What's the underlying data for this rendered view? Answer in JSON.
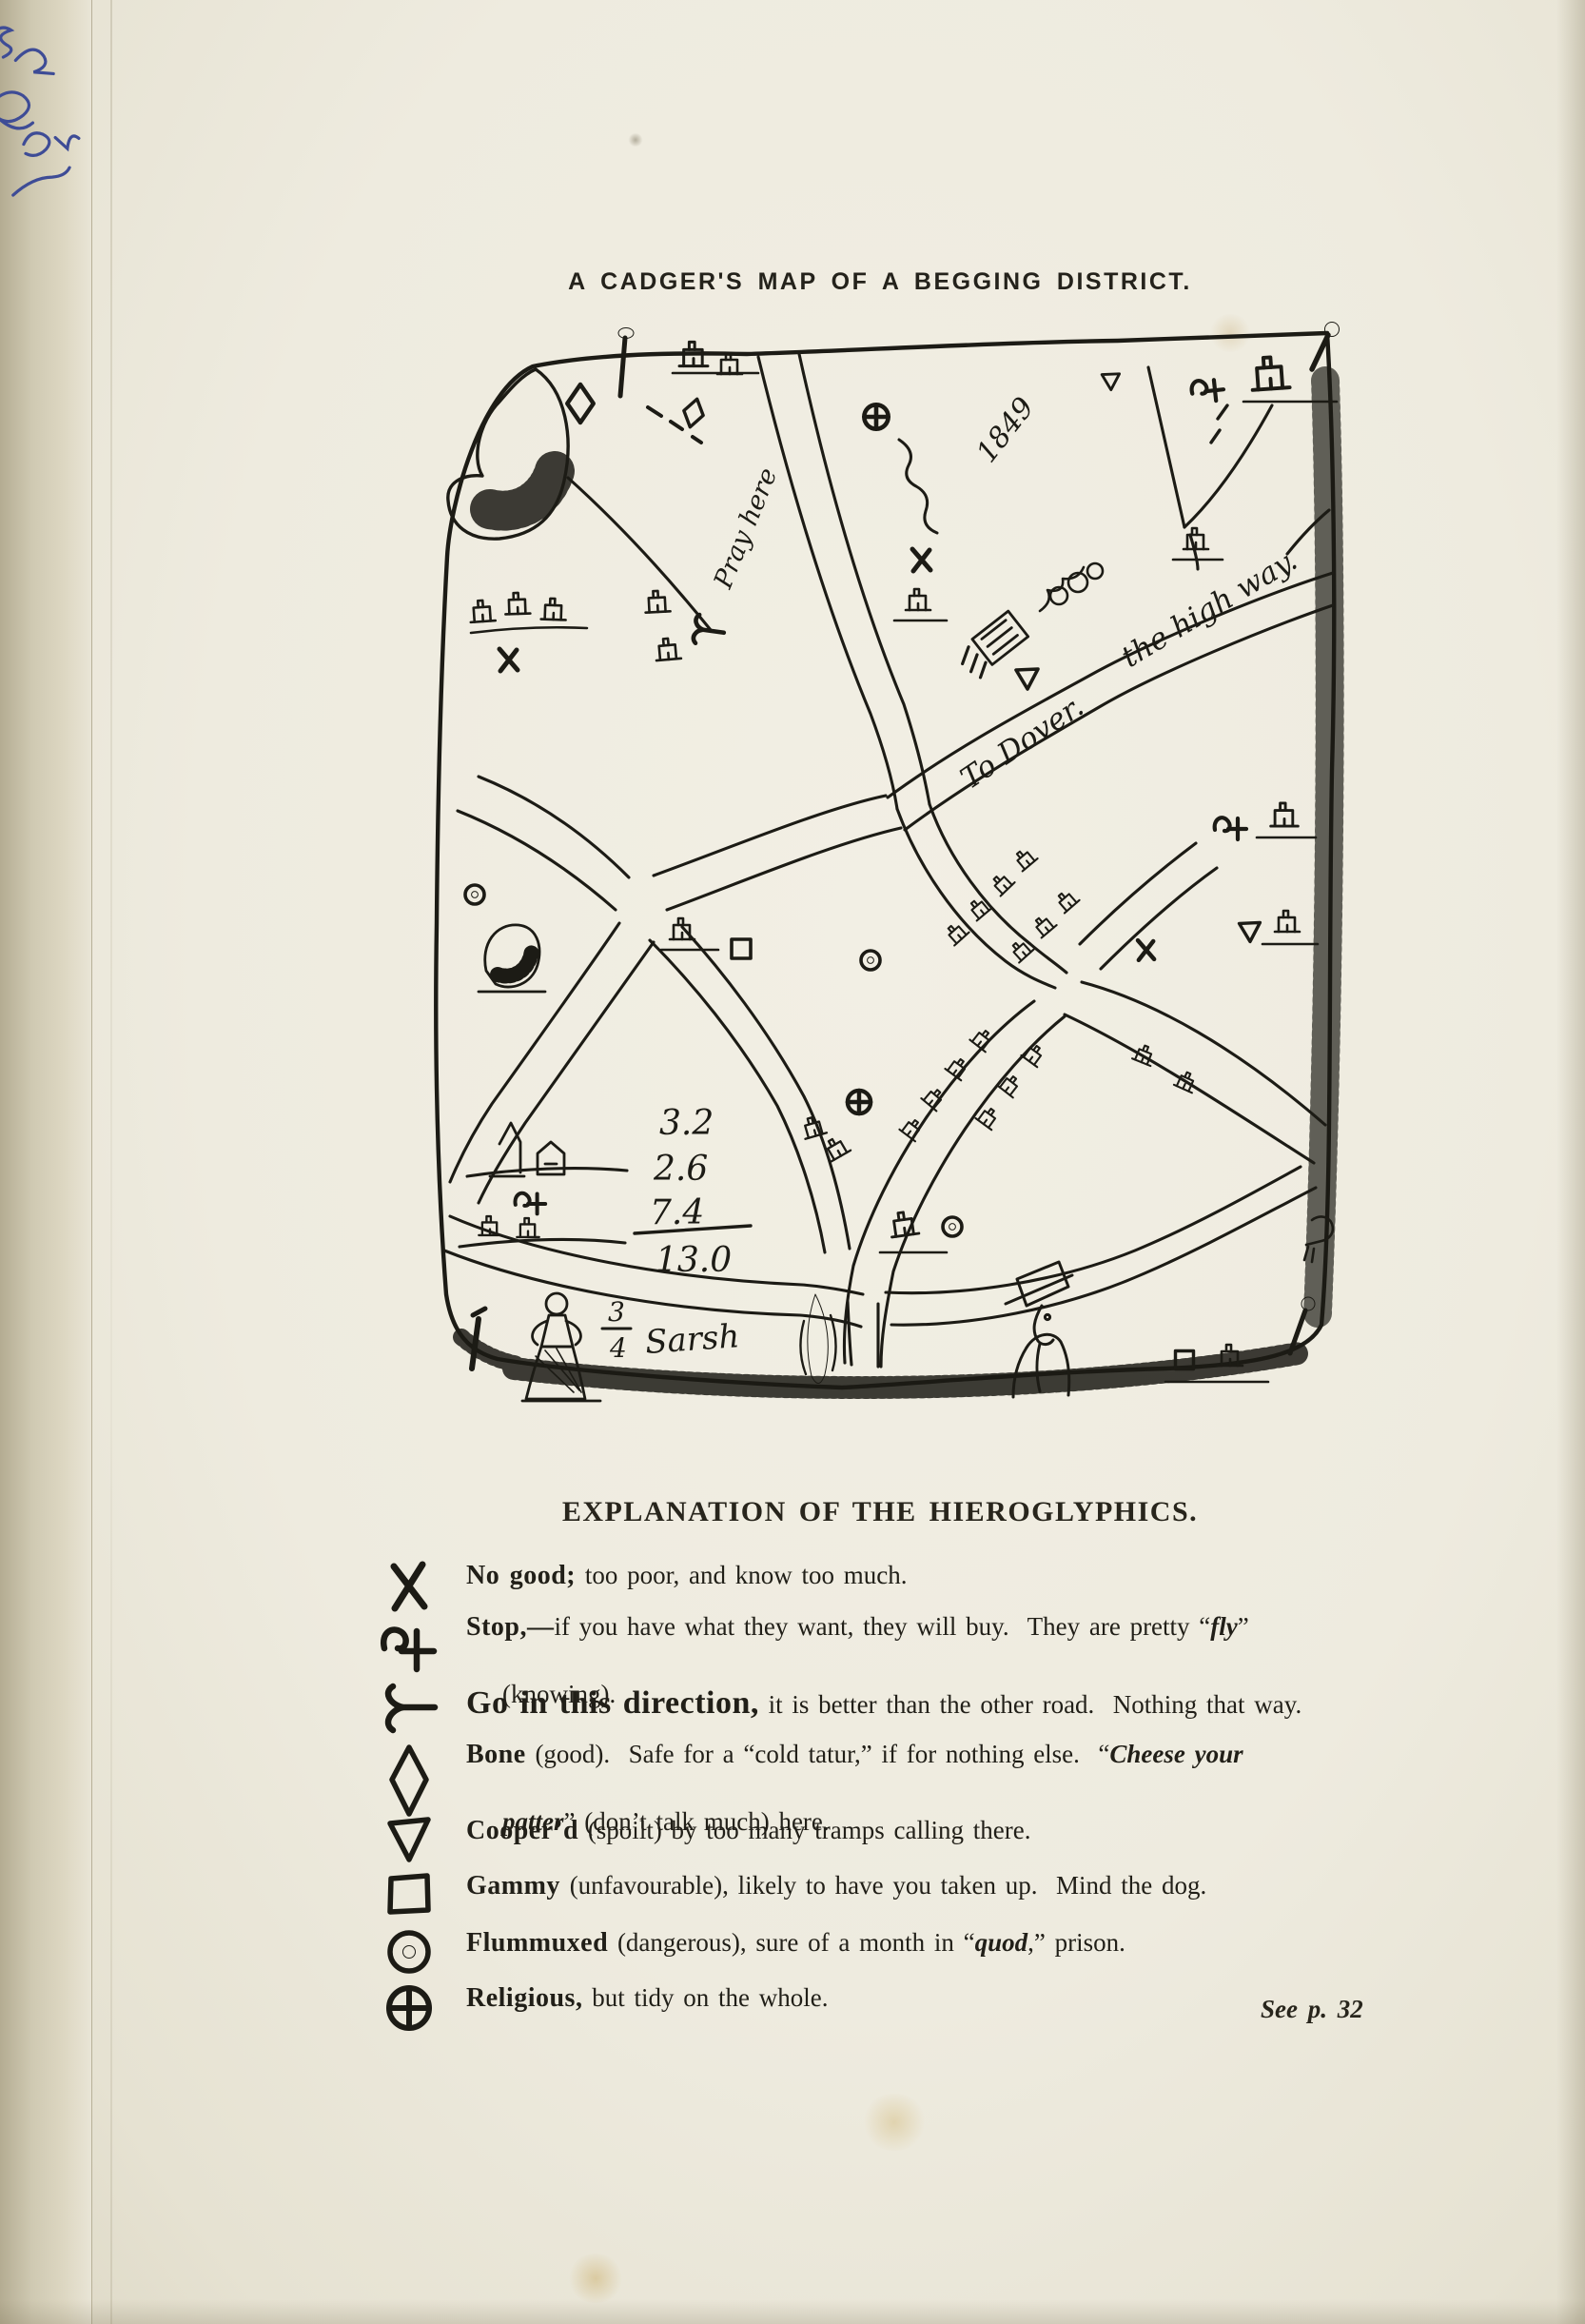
{
  "page": {
    "title": "A CADGER'S MAP OF A BEGGING DISTRICT.",
    "heading": "EXPLANATION OF THE HIEROGLYPHICS.",
    "see_note": "See p. 32",
    "marginalia": "(illegible blue-ink handwriting)"
  },
  "map": {
    "year": "1849",
    "pray_here": "Pray here",
    "to_dover": "To Dover.",
    "high_way": "the high way.",
    "sum_lines": [
      "3.2",
      "2.6",
      "7.4",
      "13.0"
    ],
    "fraction_top": "3",
    "fraction_bottom": "4",
    "sarsh": "Sarsh"
  },
  "legend": {
    "items": [
      {
        "symbol": "x-mark",
        "term": "No good;",
        "rest": " too poor, and know too much."
      },
      {
        "symbol": "stop-squiggle-cross",
        "term": "Stop,—",
        "rest": "if you have what they want, they will buy.  They are pretty “",
        "italic": "fly",
        "rest2": "”",
        "line2": "(knowing)."
      },
      {
        "symbol": "fork-direction",
        "term": "Go in this direction,",
        "rest": " it is better than the other road.  Nothing that way."
      },
      {
        "symbol": "diamond",
        "term": "Bone",
        "rest": " (good).  Safe for a “cold tatur,” if for nothing else.  “",
        "italic": "Cheese your",
        "line2_italic": "patter",
        "line2_rest": "” (don’t talk much) here."
      },
      {
        "symbol": "triangle-down",
        "term": "Cooper’d",
        "rest": " (spoilt) by too many tramps calling there."
      },
      {
        "symbol": "square",
        "term": "Gammy",
        "rest": " (unfavourable), likely to have you taken up.  Mind the dog."
      },
      {
        "symbol": "circle-dot",
        "term": "Flummuxed",
        "rest": " (dangerous), sure of a month in “",
        "italic": "quod",
        "rest2": ",” prison."
      },
      {
        "symbol": "circle-cross",
        "term": "Religious,",
        "rest": " but tidy on the whole."
      }
    ]
  }
}
